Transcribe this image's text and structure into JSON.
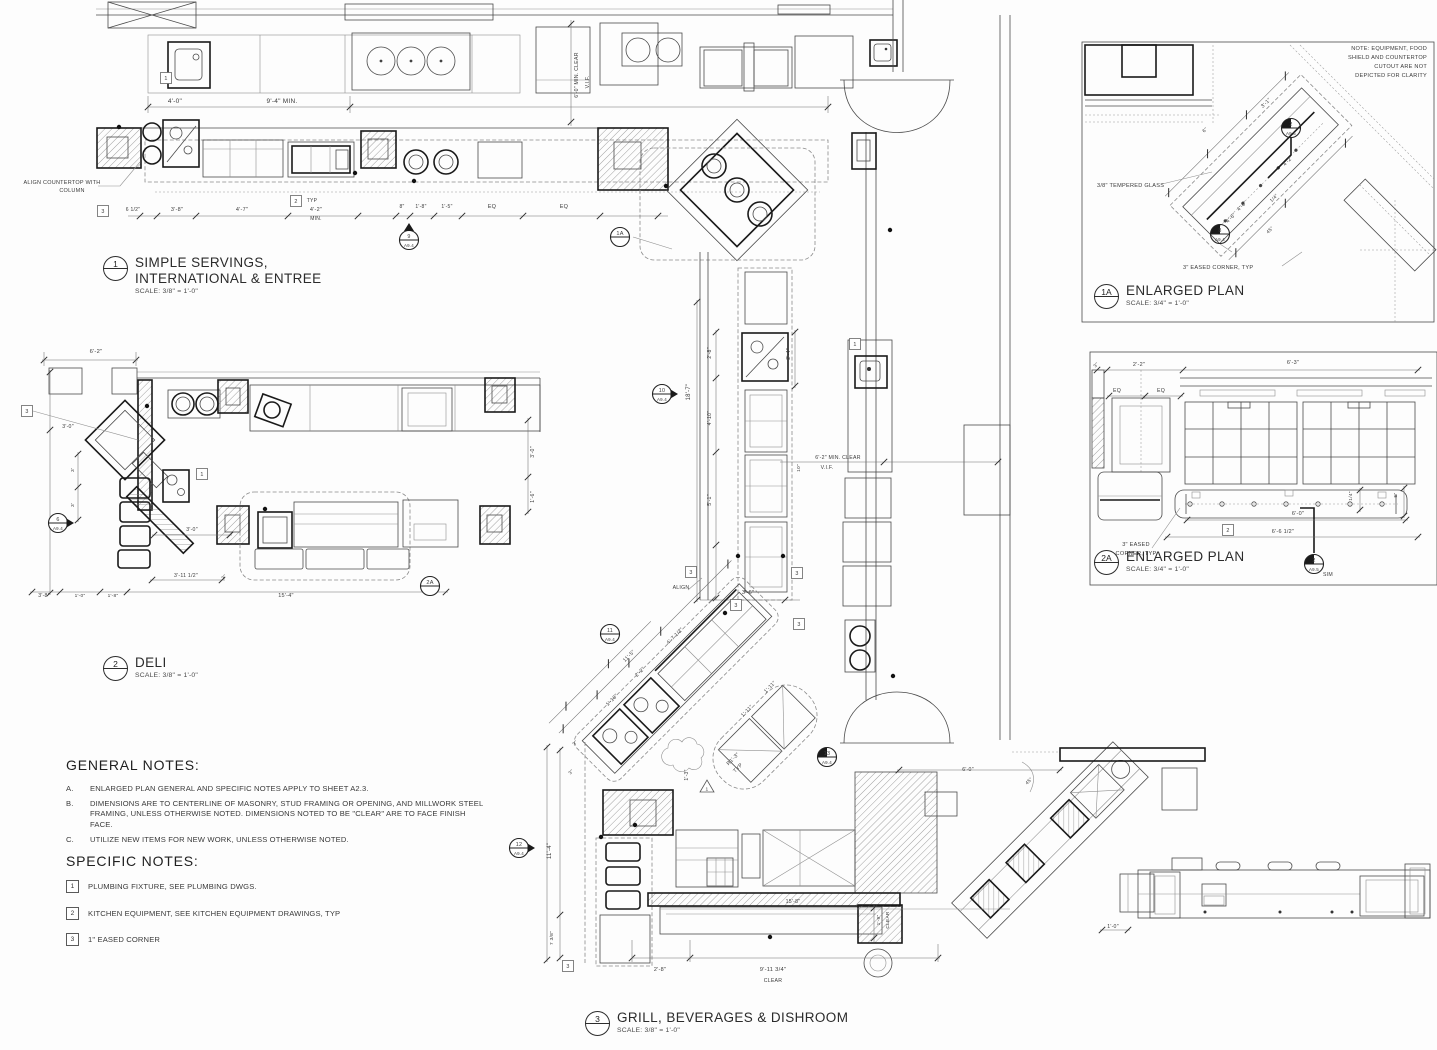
{
  "drawing": {
    "plans": [
      {
        "num": "1",
        "title": "SIMPLE SERVINGS,",
        "title2": "INTERNATIONAL & ENTREE",
        "scale": "SCALE: 3/8\" = 1'-0\""
      },
      {
        "num": "2",
        "title": "DELI",
        "scale": "SCALE: 3/8\" = 1'-0\""
      },
      {
        "num": "3",
        "title": "GRILL, BEVERAGES & DISHROOM",
        "scale": "SCALE: 3/8\" = 1'-0\""
      },
      {
        "num": "1A",
        "title": "ENLARGED PLAN",
        "scale": "SCALE: 3/4\" = 1'-0\""
      },
      {
        "num": "2A",
        "title": "ENLARGED PLAN",
        "scale": "SCALE: 3/4\" = 1'-0\""
      }
    ],
    "general_notes": {
      "heading": "GENERAL NOTES:",
      "items": [
        {
          "key": "A.",
          "text": "ENLARGED PLAN GENERAL AND SPECIFIC NOTES APPLY TO SHEET A2.3."
        },
        {
          "key": "B.",
          "text": "DIMENSIONS ARE TO CENTERLINE OF MASONRY, STUD FRAMING OR OPENING, AND MILLWORK STEEL FRAMING, UNLESS OTHERWISE NOTED.  DIMENSIONS NOTED TO BE \"CLEAR\" ARE TO FACE FINISH FACE."
        },
        {
          "key": "C.",
          "text": "UTILIZE NEW ITEMS FOR NEW WORK, UNLESS OTHERWISE NOTED."
        }
      ]
    },
    "specific_notes": {
      "heading": "SPECIFIC NOTES:",
      "items": [
        {
          "tag": "1",
          "text": "PLUMBING FIXTURE, SEE PLUMBING DWGS."
        },
        {
          "tag": "2",
          "text": "KITCHEN EQUIPMENT, SEE KITCHEN EQUIPMENT DRAWINGS, TYP"
        },
        {
          "tag": "3",
          "text": "1\" EASED CORNER"
        }
      ]
    },
    "annotations": [
      {
        "t": "4'-0\"",
        "x": 175,
        "y": 103
      },
      {
        "t": "9'-4\" MIN.",
        "x": 282,
        "y": 103
      },
      {
        "t": "ALIGN COUNTERTOP WITH",
        "x": 62,
        "y": 184,
        "s": 5.5
      },
      {
        "t": "COLUMN",
        "x": 72,
        "y": 192,
        "s": 5.5
      },
      {
        "t": "6 1/2\"",
        "x": 133,
        "y": 211,
        "s": 5
      },
      {
        "t": "3'-8\"",
        "x": 177,
        "y": 211,
        "s": 5.5
      },
      {
        "t": "4'-7\"",
        "x": 242,
        "y": 211,
        "s": 5.5
      },
      {
        "t": "4'-2\"",
        "x": 316,
        "y": 211,
        "s": 5.5
      },
      {
        "t": "MIN.",
        "x": 316,
        "y": 220,
        "s": 5
      },
      {
        "t": "TYP",
        "x": 312,
        "y": 202,
        "s": 5
      },
      {
        "t": "8\"",
        "x": 402,
        "y": 208,
        "s": 5
      },
      {
        "t": "1'-8\"",
        "x": 421,
        "y": 208,
        "s": 5
      },
      {
        "t": "1'-5\"",
        "x": 447,
        "y": 208,
        "s": 5
      },
      {
        "t": "EQ",
        "x": 492,
        "y": 208,
        "s": 5.5
      },
      {
        "t": "EQ",
        "x": 564,
        "y": 208,
        "s": 5.5
      },
      {
        "t": "6'-0\" MIN. CLEAR",
        "x": 578,
        "y": 75,
        "r": -90,
        "s": 5.2
      },
      {
        "t": "V.I.F.",
        "x": 589,
        "y": 82,
        "r": -90,
        "s": 5.2
      },
      {
        "t": "18'-7\"",
        "x": 690,
        "y": 392,
        "r": -90,
        "s": 6
      },
      {
        "t": "2'-8\"",
        "x": 711,
        "y": 353,
        "r": -90,
        "s": 5.2
      },
      {
        "t": "4'-10\"",
        "x": 711,
        "y": 418,
        "r": -90,
        "s": 5.2
      },
      {
        "t": "5'-1\"",
        "x": 711,
        "y": 500,
        "r": -90,
        "s": 5.2
      },
      {
        "t": "2'-4\"",
        "x": 790,
        "y": 354,
        "r": -90,
        "s": 5.2
      },
      {
        "t": "10\"",
        "x": 800,
        "y": 468,
        "r": -90,
        "s": 4.8
      },
      {
        "t": "6'-2\" MIN. CLEAR",
        "x": 838,
        "y": 459,
        "s": 5.2
      },
      {
        "t": "V.I.F.",
        "x": 827,
        "y": 469,
        "s": 5.2
      },
      {
        "t": "ALIGN",
        "x": 681,
        "y": 589,
        "s": 5.2
      },
      {
        "t": "3'-6\"",
        "x": 748,
        "y": 594,
        "s": 5.5
      },
      {
        "t": "4'-7 1/2\"",
        "x": 676,
        "y": 637,
        "r": -45,
        "s": 5.2
      },
      {
        "t": "11'-5\"",
        "x": 630,
        "y": 657,
        "r": -45,
        "s": 5.2
      },
      {
        "t": "2'-2\"",
        "x": 641,
        "y": 673,
        "r": -45,
        "s": 5.2
      },
      {
        "t": "1'-10\"",
        "x": 613,
        "y": 701,
        "r": -45,
        "s": 5.2
      },
      {
        "t": "1'-11\"",
        "x": 748,
        "y": 712,
        "r": -45,
        "s": 5.2
      },
      {
        "t": "1'-11\"",
        "x": 771,
        "y": 688,
        "r": -45,
        "s": 5.2
      },
      {
        "t": "R1'-3\"",
        "x": 734,
        "y": 760,
        "r": -45,
        "s": 5.2
      },
      {
        "t": "TYP",
        "x": 739,
        "y": 769,
        "r": -45,
        "s": 5.2
      },
      {
        "t": "1'-3\"",
        "x": 688,
        "y": 775,
        "r": -90,
        "s": 5
      },
      {
        "t": "3\"",
        "x": 576,
        "y": 744,
        "r": -45,
        "s": 4.8
      },
      {
        "t": "3\"",
        "x": 572,
        "y": 773,
        "r": -45,
        "s": 4.8
      },
      {
        "t": "11'-4\"",
        "x": 551,
        "y": 851,
        "r": -90,
        "s": 6
      },
      {
        "t": "7 3/8\"",
        "x": 553,
        "y": 938,
        "r": -90,
        "s": 4.8
      },
      {
        "t": "15'-8\"",
        "x": 793,
        "y": 903,
        "s": 5.2
      },
      {
        "t": "1'-9\"",
        "x": 880,
        "y": 920,
        "r": -90,
        "s": 4.8
      },
      {
        "t": "CLEAR",
        "x": 889,
        "y": 920,
        "r": -90,
        "s": 4.8
      },
      {
        "t": "2'-8\"",
        "x": 660,
        "y": 971,
        "s": 5.5
      },
      {
        "t": "9'-11 3/4\"",
        "x": 773,
        "y": 971,
        "s": 5.8
      },
      {
        "t": "CLEAR",
        "x": 773,
        "y": 982,
        "s": 5.2
      },
      {
        "t": "6'-0\"",
        "x": 968,
        "y": 771,
        "s": 5.2
      },
      {
        "t": "45°",
        "x": 1030,
        "y": 782,
        "r": -45,
        "s": 4.8
      },
      {
        "t": "1'-0\"",
        "x": 1113,
        "y": 928,
        "s": 5.2
      },
      {
        "t": "6'-2\"",
        "x": 96,
        "y": 353,
        "s": 5.8
      },
      {
        "t": "3'-0\"",
        "x": 68,
        "y": 428,
        "s": 5.2
      },
      {
        "t": "3'",
        "x": 74,
        "y": 470,
        "r": -90,
        "s": 4.8
      },
      {
        "t": "3'",
        "x": 74,
        "y": 505,
        "r": -90,
        "s": 4.8
      },
      {
        "t": "3'-0\"",
        "x": 192,
        "y": 531,
        "s": 5.2
      },
      {
        "t": "3'-11 1/2\"",
        "x": 186,
        "y": 577,
        "s": 5.2
      },
      {
        "t": "3\"",
        "x": 225,
        "y": 578,
        "r": -45,
        "s": 4.8
      },
      {
        "t": "3'-8\"",
        "x": 44,
        "y": 597,
        "s": 5.2
      },
      {
        "t": "1'-0\"",
        "x": 80,
        "y": 597,
        "s": 4.8
      },
      {
        "t": "1'-8\"",
        "x": 113,
        "y": 597,
        "s": 4.8
      },
      {
        "t": "15'-4\"",
        "x": 286,
        "y": 597,
        "s": 5.5
      },
      {
        "t": "3'-0\"",
        "x": 534,
        "y": 452,
        "r": -90,
        "s": 5.2
      },
      {
        "t": "1'-6\"",
        "x": 534,
        "y": 497,
        "r": -90,
        "s": 5.2
      },
      {
        "t": "NOTE: EQUIPMENT, FOOD",
        "x": 1427,
        "y": 50,
        "s": 5.6,
        "a": "end"
      },
      {
        "t": "SHIELD AND COUNTERTOP",
        "x": 1427,
        "y": 59,
        "s": 5.6,
        "a": "end"
      },
      {
        "t": "CUTOUT ARE NOT",
        "x": 1427,
        "y": 68,
        "s": 5.6,
        "a": "end"
      },
      {
        "t": "DEPICTED FOR CLARITY",
        "x": 1427,
        "y": 77,
        "s": 5.6,
        "a": "end"
      },
      {
        "t": "3/8\" TEMPERED GLASS",
        "x": 1097,
        "y": 187,
        "s": 5.6,
        "a": "start"
      },
      {
        "t": "3\" EASED CORNER, TYP",
        "x": 1183,
        "y": 269,
        "s": 5.6,
        "a": "start"
      },
      {
        "t": "3'-1\"",
        "x": 1267,
        "y": 104,
        "r": -45,
        "s": 5.2
      },
      {
        "t": "4'-2\"",
        "x": 1289,
        "y": 162,
        "r": -45,
        "s": 5.2
      },
      {
        "t": "4'-0\"",
        "x": 1243,
        "y": 207,
        "r": -45,
        "s": 5.2
      },
      {
        "t": "4'-6\"",
        "x": 1232,
        "y": 219,
        "r": -45,
        "s": 5.2
      },
      {
        "t": "1/4\"",
        "x": 1275,
        "y": 199,
        "r": -45,
        "s": 4.8
      },
      {
        "t": "6\"",
        "x": 1206,
        "y": 131,
        "r": -45,
        "s": 4.8
      },
      {
        "t": "45°",
        "x": 1271,
        "y": 231,
        "r": -45,
        "s": 4.8
      },
      {
        "t": "2'-2\"",
        "x": 1139,
        "y": 366,
        "s": 5.5
      },
      {
        "t": "6'-3\"",
        "x": 1293,
        "y": 364,
        "s": 5.5
      },
      {
        "t": "3\"",
        "x": 1097,
        "y": 366,
        "r": -45,
        "s": 4.8
      },
      {
        "t": "EQ",
        "x": 1117,
        "y": 392,
        "s": 5.2
      },
      {
        "t": "EQ",
        "x": 1161,
        "y": 392,
        "s": 5.2
      },
      {
        "t": "1/4\"",
        "x": 1352,
        "y": 496,
        "r": -90,
        "s": 4.8
      },
      {
        "t": "5\"",
        "x": 1397,
        "y": 495,
        "r": -90,
        "s": 4.8
      },
      {
        "t": "6'-0\"",
        "x": 1298,
        "y": 515,
        "s": 5.5
      },
      {
        "t": "6'-6 1/2\"",
        "x": 1283,
        "y": 533,
        "s": 5.5
      },
      {
        "t": "3\" EASED",
        "x": 1136,
        "y": 546,
        "s": 5.6
      },
      {
        "t": "CORNER, TYP",
        "x": 1136,
        "y": 555,
        "s": 5.6
      },
      {
        "t": "SIM",
        "x": 1328,
        "y": 576,
        "s": 5.2
      }
    ],
    "markers": [
      {
        "n": "9",
        "sh": "A9.4",
        "x": 409,
        "y": 240,
        "tri": "up"
      },
      {
        "n": "1A",
        "sh": "",
        "x": 620,
        "y": 237
      },
      {
        "n": "10",
        "sh": "A9.4",
        "x": 662,
        "y": 394,
        "tri": "right"
      },
      {
        "n": "6",
        "sh": "A9.4",
        "x": 58,
        "y": 523,
        "tri": "right"
      },
      {
        "n": "2A",
        "sh": "",
        "x": 430,
        "y": 586
      },
      {
        "n": "11",
        "sh": "A9.4",
        "x": 610,
        "y": 634
      },
      {
        "n": "13",
        "sh": "A9.4",
        "x": 827,
        "y": 757,
        "half": true
      },
      {
        "n": "12",
        "sh": "A9.4",
        "x": 519,
        "y": 848,
        "tri": "right"
      },
      {
        "n": "2",
        "sh": "A9.5",
        "x": 1291,
        "y": 128,
        "half": true
      },
      {
        "n": "8",
        "sh": "A9.4",
        "x": 1220,
        "y": 234,
        "half": true
      },
      {
        "n": "2",
        "sh": "A9.5",
        "x": 1314,
        "y": 564,
        "half": true
      }
    ],
    "tags": [
      {
        "n": "3",
        "x": 103,
        "y": 211
      },
      {
        "n": "1",
        "x": 166,
        "y": 78
      },
      {
        "n": "2",
        "x": 296,
        "y": 201
      },
      {
        "n": "3",
        "x": 27,
        "y": 411
      },
      {
        "n": "1",
        "x": 202,
        "y": 474
      },
      {
        "n": "1",
        "x": 855,
        "y": 344
      },
      {
        "n": "3",
        "x": 691,
        "y": 572
      },
      {
        "n": "3",
        "x": 797,
        "y": 573
      },
      {
        "n": "3",
        "x": 736,
        "y": 605
      },
      {
        "n": "3",
        "x": 799,
        "y": 624
      },
      {
        "n": "3",
        "x": 568,
        "y": 966
      },
      {
        "n": "2",
        "x": 1228,
        "y": 530
      }
    ],
    "triangle_tags": [
      {
        "n": "1",
        "x": 707,
        "y": 788
      }
    ]
  }
}
